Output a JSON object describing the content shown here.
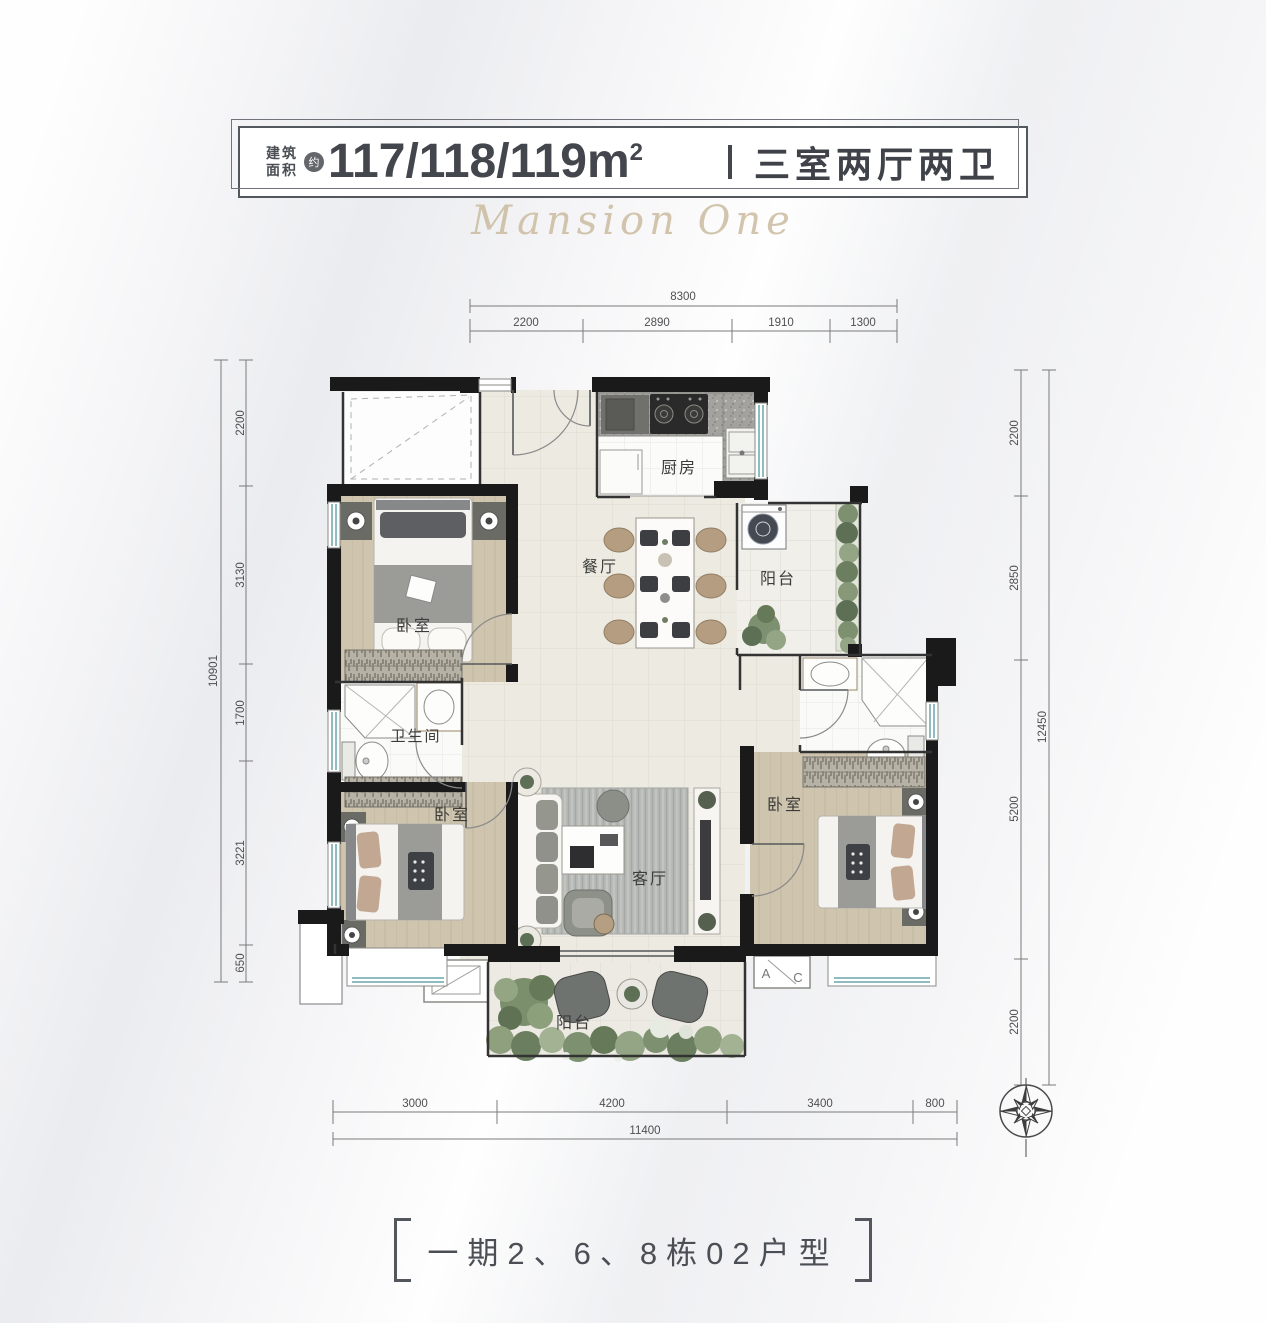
{
  "header": {
    "area_label_1": "建筑",
    "area_label_2": "面积",
    "approx": "约",
    "area_value": "117/118/119m",
    "area_sup": "2",
    "layout_type": "三室两厅两卫"
  },
  "watermark": "Mansion One",
  "rooms": {
    "kitchen": "厨房",
    "dining": "餐厅",
    "balcony_north": "阳台",
    "bedroom_nw": "卧室",
    "bathroom": "卫生间",
    "bedroom_sw": "卧室",
    "living": "客厅",
    "bedroom_east": "卧室",
    "balcony_south": "阳台",
    "ac_a": "A",
    "ac_c": "C"
  },
  "dims": {
    "top": {
      "total": "8300",
      "segs": [
        "2200",
        "2890",
        "1910",
        "1300"
      ]
    },
    "left": {
      "total": "10901",
      "segs": [
        "2200",
        "3130",
        "1700",
        "3221",
        "650"
      ]
    },
    "right": {
      "total": "12450",
      "segs": [
        "2200",
        "2850",
        "5200",
        "2200"
      ]
    },
    "bottom": {
      "total": "11400",
      "segs": [
        "3000",
        "4200",
        "3400",
        "800"
      ]
    }
  },
  "footer": "一期2、6、8栋02户型"
}
